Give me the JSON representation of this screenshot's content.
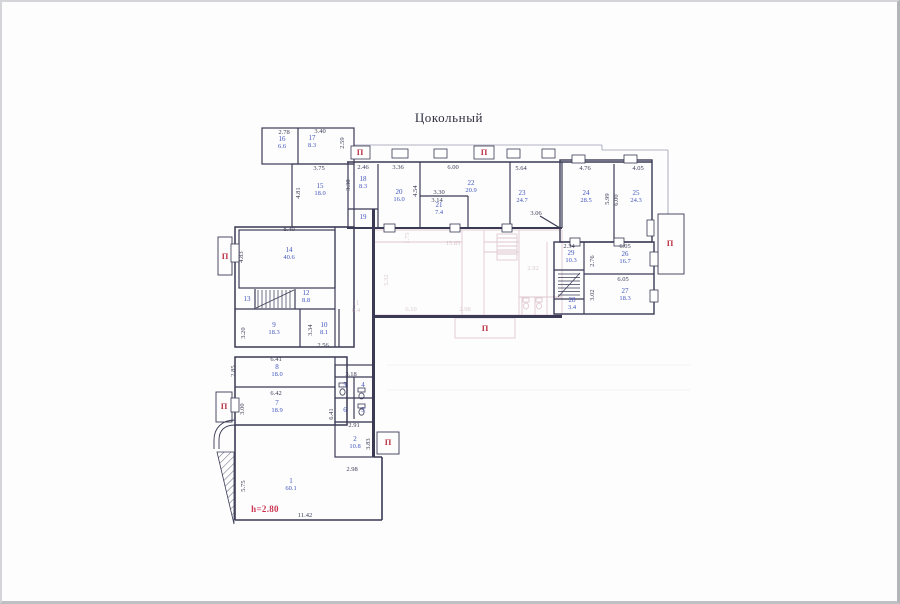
{
  "plan": {
    "title": "Цокольный",
    "height_note": "h=2.80",
    "marker_glyph": "П",
    "colors": {
      "wall": "#3a3a55",
      "room_label": "#4055bb",
      "dim_label": "#3c3c55",
      "marker_red": "#bb3344",
      "faint_wall": "#d9bcc4"
    },
    "title_pos": {
      "x": 447,
      "y": 116
    },
    "note_pos": {
      "x": 263,
      "y": 507
    },
    "rooms": [
      {
        "n": "16",
        "a": "6.6",
        "x": 280,
        "y": 141
      },
      {
        "n": "17",
        "a": "8.3",
        "x": 310,
        "y": 140
      },
      {
        "n": "15",
        "a": "18.0",
        "x": 318,
        "y": 188
      },
      {
        "n": "18",
        "a": "8.3",
        "x": 361,
        "y": 181
      },
      {
        "n": "19",
        "x": 361,
        "y": 215
      },
      {
        "n": "20",
        "a": "16.0",
        "x": 397,
        "y": 194
      },
      {
        "n": "21",
        "a": "7.4",
        "x": 437,
        "y": 207
      },
      {
        "n": "22",
        "a": "20.9",
        "x": 469,
        "y": 185
      },
      {
        "n": "23",
        "a": "24.7",
        "x": 520,
        "y": 195
      },
      {
        "n": "24",
        "a": "28.5",
        "x": 584,
        "y": 195
      },
      {
        "n": "25",
        "a": "24.3",
        "x": 634,
        "y": 195
      },
      {
        "n": "26",
        "a": "16.7",
        "x": 623,
        "y": 256
      },
      {
        "n": "27",
        "a": "18.3",
        "x": 623,
        "y": 293
      },
      {
        "n": "28",
        "a": "3.4",
        "x": 570,
        "y": 302
      },
      {
        "n": "29",
        "a": "10.3",
        "x": 569,
        "y": 255
      },
      {
        "n": "14",
        "a": "40.6",
        "x": 287,
        "y": 252
      },
      {
        "n": "13",
        "x": 245,
        "y": 297
      },
      {
        "n": "12",
        "a": "8.8",
        "x": 304,
        "y": 295
      },
      {
        "n": "11",
        "a": "8.4",
        "x": 354,
        "y": 305,
        "f": 1
      },
      {
        "n": "9",
        "a": "18.3",
        "x": 272,
        "y": 327
      },
      {
        "n": "10",
        "a": "8.1",
        "x": 322,
        "y": 327
      },
      {
        "n": "8",
        "a": "18.0",
        "x": 275,
        "y": 369
      },
      {
        "n": "7",
        "a": "18.9",
        "x": 275,
        "y": 405
      },
      {
        "n": "5",
        "x": 343,
        "y": 383
      },
      {
        "n": "4",
        "x": 361,
        "y": 383
      },
      {
        "n": "6",
        "x": 343,
        "y": 408
      },
      {
        "n": "3",
        "x": 361,
        "y": 408
      },
      {
        "n": "2",
        "a": "10.8",
        "x": 353,
        "y": 441
      },
      {
        "n": "1",
        "a": "60.1",
        "x": 289,
        "y": 483
      }
    ],
    "dims": [
      {
        "t": "2.78",
        "x": 282,
        "y": 131
      },
      {
        "t": "3.40",
        "x": 318,
        "y": 130
      },
      {
        "t": "2.59",
        "x": 341,
        "y": 141,
        "r": 1
      },
      {
        "t": "3.75",
        "x": 317,
        "y": 167
      },
      {
        "t": "4.81",
        "x": 297,
        "y": 191,
        "r": 1
      },
      {
        "t": "2.46",
        "x": 361,
        "y": 166
      },
      {
        "t": "3.36",
        "x": 396,
        "y": 166
      },
      {
        "t": "6.00",
        "x": 451,
        "y": 166
      },
      {
        "t": "5.64",
        "x": 519,
        "y": 167
      },
      {
        "t": "4.76",
        "x": 583,
        "y": 167
      },
      {
        "t": "4.05",
        "x": 636,
        "y": 167
      },
      {
        "t": "3.38",
        "x": 347,
        "y": 183,
        "r": 1
      },
      {
        "t": "4.54",
        "x": 414,
        "y": 189,
        "r": 1
      },
      {
        "t": "3.30",
        "x": 437,
        "y": 191
      },
      {
        "t": "3.14",
        "x": 435,
        "y": 199
      },
      {
        "t": "3.06",
        "x": 534,
        "y": 212
      },
      {
        "t": "5.99",
        "x": 606,
        "y": 197,
        "r": 1
      },
      {
        "t": "6.00",
        "x": 615,
        "y": 198,
        "r": 1
      },
      {
        "t": "8.40",
        "x": 287,
        "y": 228
      },
      {
        "t": "4.83",
        "x": 240,
        "y": 255,
        "r": 1
      },
      {
        "t": "2.34",
        "x": 567,
        "y": 245
      },
      {
        "t": "6.05",
        "x": 623,
        "y": 245
      },
      {
        "t": "2.76",
        "x": 591,
        "y": 259,
        "r": 1
      },
      {
        "t": "6.05",
        "x": 621,
        "y": 278
      },
      {
        "t": "3.02",
        "x": 591,
        "y": 293,
        "r": 1
      },
      {
        "t": "3.20",
        "x": 242,
        "y": 331,
        "r": 1
      },
      {
        "t": "3.34",
        "x": 309,
        "y": 328,
        "r": 1
      },
      {
        "t": "2.56",
        "x": 321,
        "y": 344
      },
      {
        "t": "6.41",
        "x": 274,
        "y": 358
      },
      {
        "t": "2.85",
        "x": 232,
        "y": 369,
        "r": 1
      },
      {
        "t": "6.42",
        "x": 274,
        "y": 392
      },
      {
        "t": "3.00",
        "x": 241,
        "y": 407,
        "r": 1
      },
      {
        "t": "3.18",
        "x": 349,
        "y": 373
      },
      {
        "t": "6.41",
        "x": 330,
        "y": 412,
        "r": 1
      },
      {
        "t": "2.91",
        "x": 352,
        "y": 424
      },
      {
        "t": "3.83",
        "x": 367,
        "y": 442,
        "r": 1
      },
      {
        "t": "2.98",
        "x": 350,
        "y": 468
      },
      {
        "t": "5.75",
        "x": 242,
        "y": 484,
        "r": 1
      },
      {
        "t": "11.42",
        "x": 303,
        "y": 514
      },
      {
        "t": "15.85",
        "x": 451,
        "y": 242,
        "f": 1
      },
      {
        "t": "1.75",
        "x": 406,
        "y": 236,
        "r": 1,
        "f": 1
      },
      {
        "t": "5.32",
        "x": 385,
        "y": 278,
        "r": 1,
        "f": 1
      },
      {
        "t": "6.10",
        "x": 409,
        "y": 308,
        "f": 1
      },
      {
        "t": "2.98",
        "x": 463,
        "y": 308,
        "f": 1
      },
      {
        "t": "2.92",
        "x": 531,
        "y": 267,
        "f": 1
      }
    ],
    "markers": [
      {
        "x": 358,
        "y": 150
      },
      {
        "x": 482,
        "y": 150
      },
      {
        "x": 223,
        "y": 254
      },
      {
        "x": 222,
        "y": 404
      },
      {
        "x": 386,
        "y": 440
      },
      {
        "x": 668,
        "y": 241
      },
      {
        "x": 483,
        "y": 326
      }
    ]
  }
}
